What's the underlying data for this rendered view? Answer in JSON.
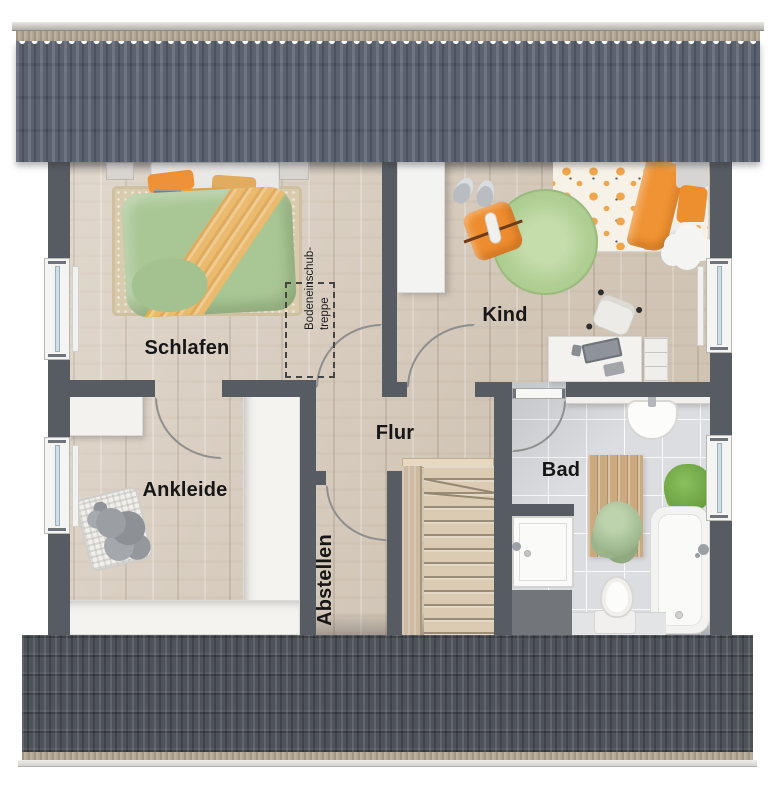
{
  "plan": {
    "type": "floor-plan",
    "rooms": {
      "schlafen": {
        "label": "Schlafen"
      },
      "kind": {
        "label": "Kind"
      },
      "ankleide": {
        "label": "Ankleide"
      },
      "flur": {
        "label": "Flur"
      },
      "abstellen": {
        "label": "Abstellen"
      },
      "bad": {
        "label": "Bad"
      }
    },
    "annotation": {
      "attic_hatch_line1": "Bodeneinschub-",
      "attic_hatch_line2": "treppe"
    }
  },
  "colors": {
    "wall": "#575c63",
    "roof_top": "#5a6270",
    "roof_bottom": "#4e535a",
    "wood": "#d9cec0",
    "tile": "#dbdde0",
    "window_glass": "#cfdde6",
    "accent_orange": "#ee9138",
    "duvet_green": "#a9c795",
    "rug_green": "#b0cf94"
  }
}
